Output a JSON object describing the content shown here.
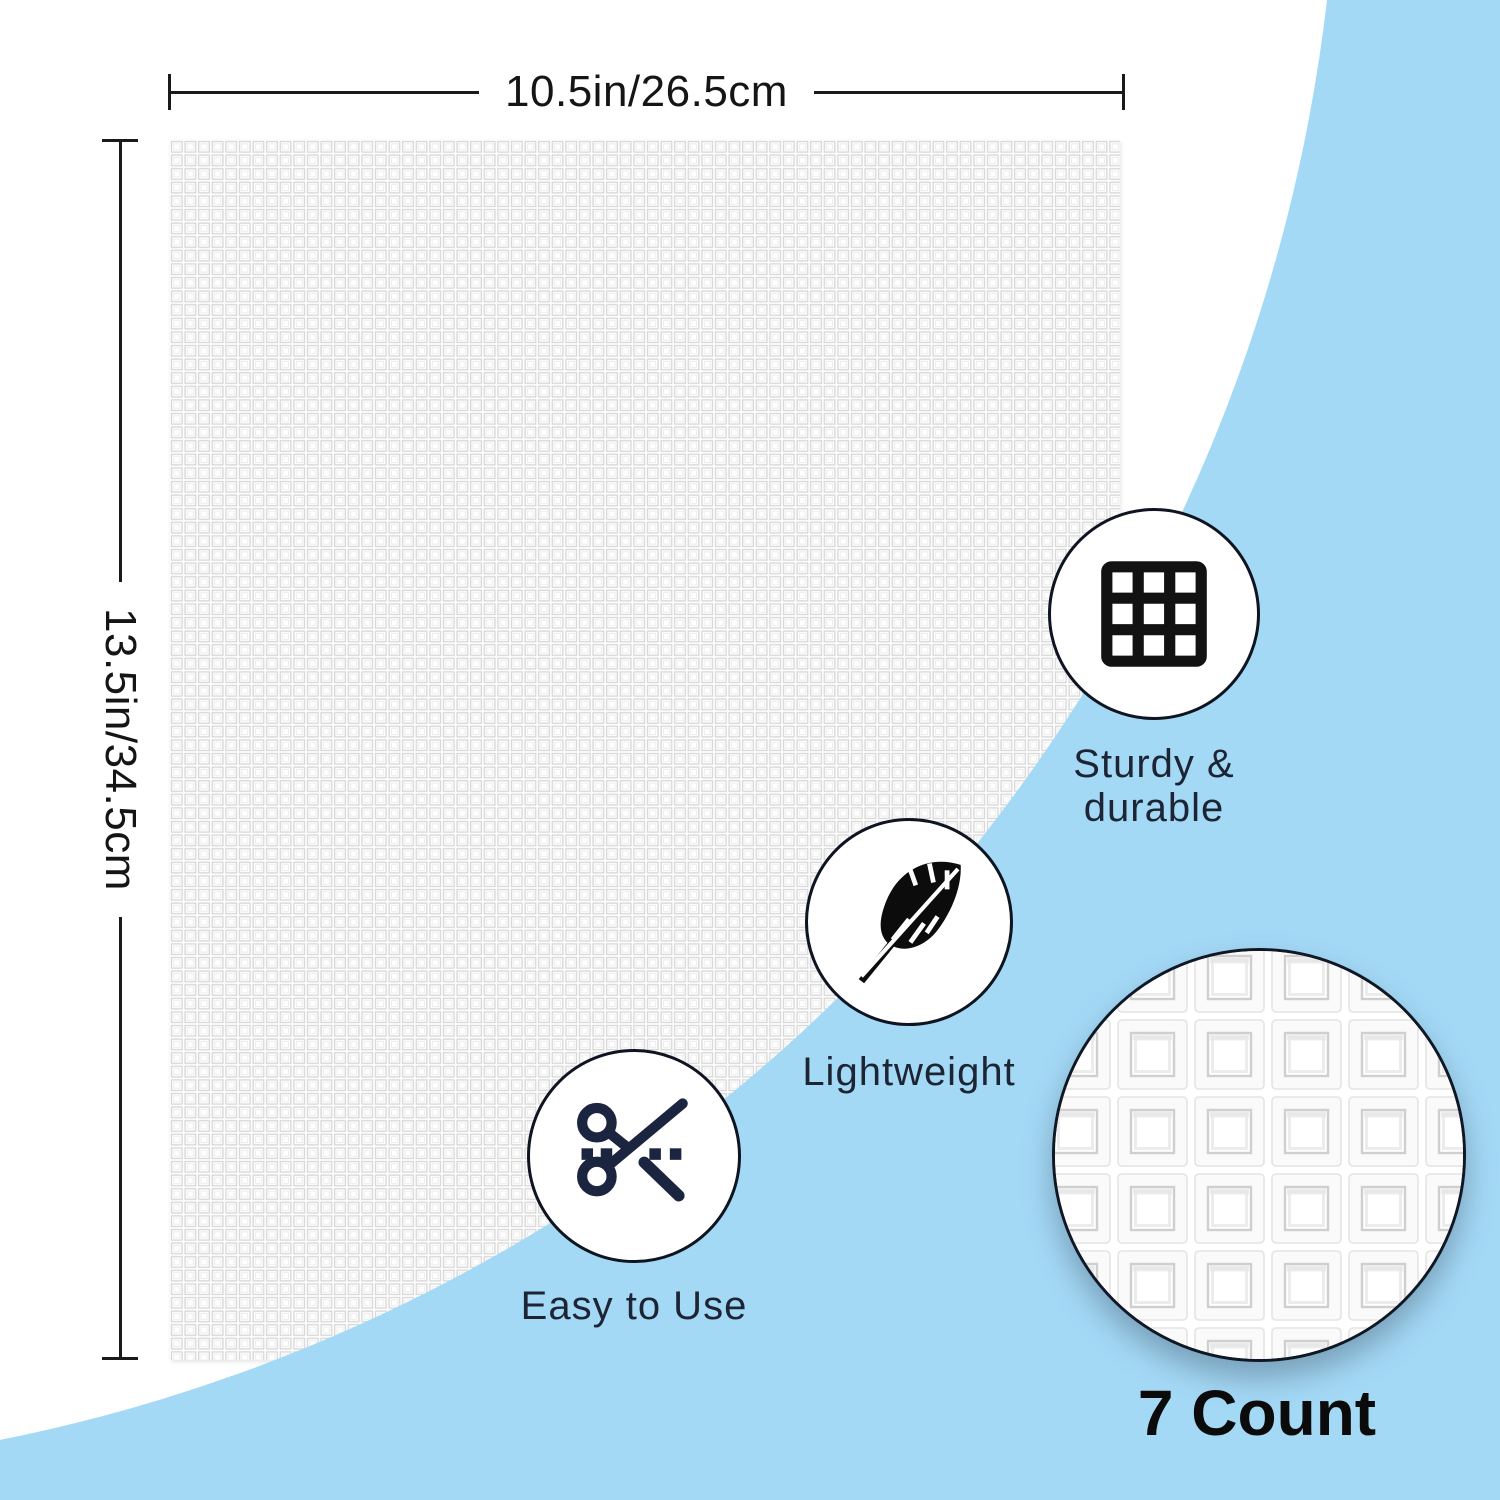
{
  "product_diagram": {
    "measurements": {
      "width_label": "10.5in/26.5cm",
      "height_label": "13.5in/34.5cm"
    },
    "features": [
      {
        "id": "sturdy",
        "icon": "grid-icon",
        "label_line1": "Sturdy &",
        "label_line2": "durable"
      },
      {
        "id": "lightweight",
        "icon": "feather-icon",
        "label": "Lightweight"
      },
      {
        "id": "easy",
        "icon": "scissors-icon",
        "label": "Easy to Use"
      }
    ],
    "detail": {
      "count_label": "7 Count"
    },
    "colors": {
      "accent_blue": "#a4d9f6",
      "measure_line": "#1a1a1a",
      "caption_navy": "#1d2535",
      "icon_black": "#121212",
      "scissors_navy": "#1b2540",
      "count_black": "#0b0b0b",
      "mesh_line": "#d8d8d8"
    }
  }
}
